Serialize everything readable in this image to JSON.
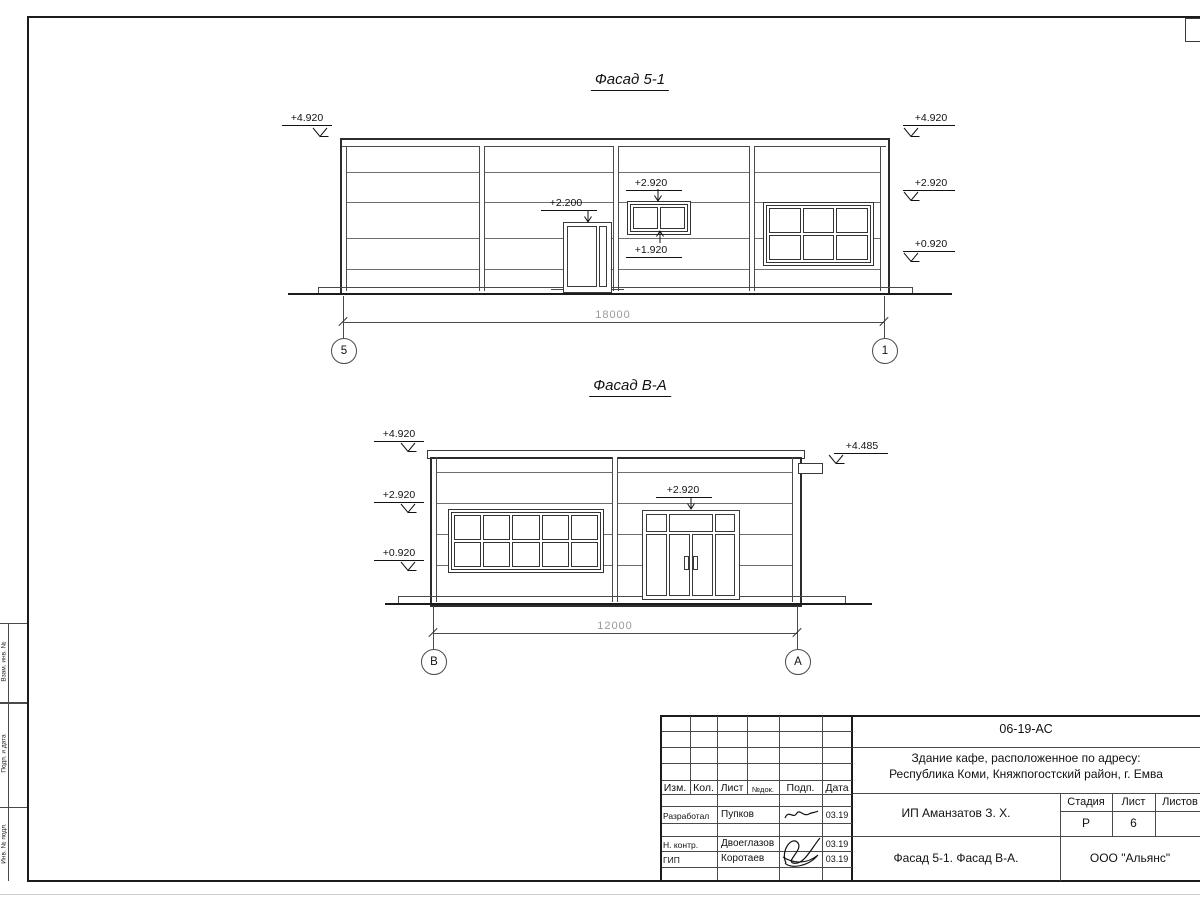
{
  "f1": {
    "title": "Фасад 5-1",
    "m_top": "+4.920",
    "m_mid": "+2.920",
    "m_low": "+0.920",
    "m_door": "+2.200",
    "m_win_top": "+2.920",
    "m_win_bot": "+1.920",
    "dim": "18000",
    "ax_l": "5",
    "ax_r": "1"
  },
  "f2": {
    "title": "Фасад В-А",
    "m_top": "+4.920",
    "m_mid": "+2.920",
    "m_low": "+0.920",
    "m_right": "+4.485",
    "m_portal": "+2.920",
    "dim": "12000",
    "ax_l": "В",
    "ax_r": "А"
  },
  "tb": {
    "doc": "06-19-АС",
    "proj1": "Здание кафе, расположенное по адресу:",
    "proj2": "Республика Коми, Княжпогостский район, г. Емва",
    "client": "ИП Аманзатов З. Х.",
    "sheet_name": "Фасад 5-1. Фасад В-А.",
    "org": "ООО \"Альянс\"",
    "h_izm": "Изм.",
    "h_kol": "Кол.",
    "h_list": "Лист",
    "h_ndoc": "№док.",
    "h_podp": "Подп.",
    "h_data": "Дата",
    "stage_l": "Стадия",
    "list_l": "Лист",
    "listov_l": "Листов",
    "stage_v": "Р",
    "list_v": "6",
    "rows": [
      {
        "role": "Разработал",
        "name": "Пупков",
        "date": "03.19"
      },
      {
        "role": "Н. контр.",
        "name": "Двоеглазов",
        "date": "03.19"
      },
      {
        "role": "ГИП",
        "name": "Коротаев",
        "date": "03.19"
      }
    ]
  },
  "frame": {
    "side_labels": [
      "Взам. инв. №",
      "Подп. и дата",
      "Инв. № подл."
    ]
  }
}
